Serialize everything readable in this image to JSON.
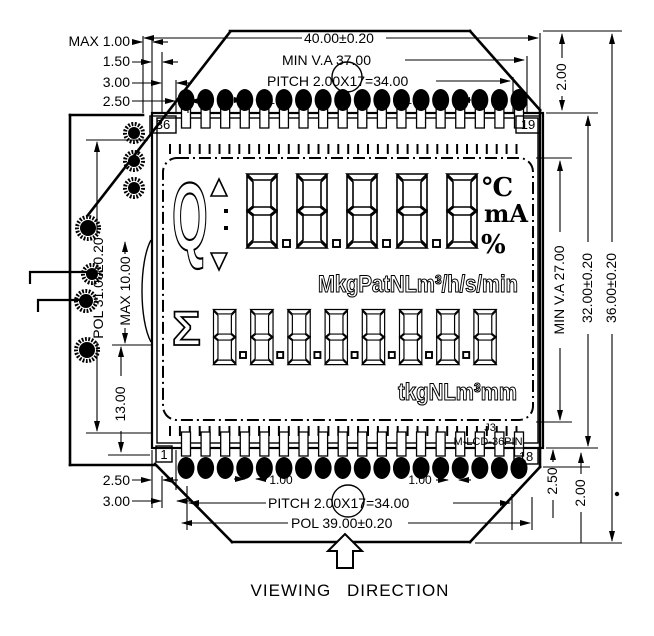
{
  "display": {
    "flow_symbol": "Q",
    "sum_symbol": "Σ",
    "row1_digit_count": 5,
    "row2_digit_count": 8,
    "temp_unit": "℃",
    "current_unit": "mA",
    "percent_unit": "%",
    "row1_units": "MkgPatNLm³/h/s/min",
    "row2_units": "tkgNLm³mm"
  },
  "pins": {
    "per_row": 18,
    "top_left": "36",
    "top_right": "19",
    "bottom_left": "1",
    "bottom_right": "18"
  },
  "connector": {
    "ref": "J3",
    "part": "M-LCD-36PIN"
  },
  "dims": {
    "max_height_top": "MAX 1.00",
    "d150": "1.50",
    "d300": "3.00",
    "d250": "2.50",
    "overall_width": "40.00±0.20",
    "va_width": "MIN V.A 37.00",
    "pitch_top": "PITCH 2.00X17=34.00",
    "pin_width_top_1": "1.00",
    "pin_width_top_2": "1.00",
    "d200_topright": "2.00",
    "va_height": "MIN V.A 27.00",
    "glass_height": "32.00±0.20",
    "overall_height": "36.00±0.20",
    "pol_height": "POL 31.00±0.20",
    "max_pin": "MAX 10.00",
    "d1300": "13.00",
    "d250_bottom": "2.50",
    "d300_bottom": "3.00",
    "pin_width_bottom_1": "1.00",
    "pin_width_bottom_2": "1.00",
    "pitch_bottom": "PITCH 2.00X17=34.00",
    "pol_width": "POL 39.00±0.20",
    "d250_bottomright": "2.50",
    "d200_bottomright": "2.00"
  },
  "footer": {
    "viewing_direction": "VIEWING DIRECTION"
  },
  "colors": {
    "ink": "#000000",
    "paper": "#ffffff"
  }
}
